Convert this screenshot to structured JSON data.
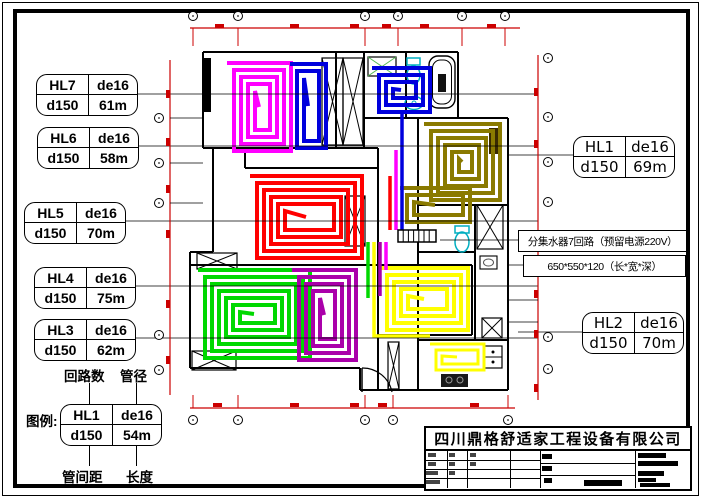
{
  "loop_labels": {
    "left": [
      {
        "id": "HL7",
        "pipe": "de16",
        "spacing": "d150",
        "length": "61m"
      },
      {
        "id": "HL6",
        "pipe": "de16",
        "spacing": "d150",
        "length": "58m"
      },
      {
        "id": "HL5",
        "pipe": "de16",
        "spacing": "d150",
        "length": "70m"
      },
      {
        "id": "HL4",
        "pipe": "de16",
        "spacing": "d150",
        "length": "75m"
      },
      {
        "id": "HL3",
        "pipe": "de16",
        "spacing": "d150",
        "length": "62m"
      }
    ],
    "right": [
      {
        "id": "HL1",
        "pipe": "de16",
        "spacing": "d150",
        "length": "69m"
      },
      {
        "id": "HL2",
        "pipe": "de16",
        "spacing": "d150",
        "length": "70m"
      }
    ],
    "legend": {
      "id": "HL1",
      "pipe": "de16",
      "spacing": "d150",
      "length": "54m"
    }
  },
  "callouts": {
    "legend_title": "图例:",
    "loops_count": "回路数",
    "pipe_dia": "管径",
    "pipe_spacing": "管间距",
    "length": "长度"
  },
  "manifold_note": {
    "line1": "分集水器7回路（预留电源220V）",
    "line2": "650*550*120（长*宽*深）"
  },
  "title_block": {
    "company": "四川鼎格舒适家工程设备有限公司"
  },
  "colors": {
    "wall": "#000000",
    "dimension_red": "#cc0000",
    "fixture_cyan": "#00aec0",
    "hatch_green": "#55bb55"
  },
  "coils": [
    {
      "loop": "HL7",
      "color": "#ff00ff",
      "x": 227,
      "y": 63,
      "w": 64,
      "h": 88,
      "gap": 7
    },
    {
      "loop": "HL6",
      "color": "#0000dd",
      "x": 290,
      "y": 64,
      "w": 36,
      "h": 84,
      "gap": 7
    },
    {
      "loop": "HL6",
      "color": "#0000dd",
      "x": 372,
      "y": 68,
      "w": 58,
      "h": 44,
      "gap": 7
    },
    {
      "loop": "HL1",
      "color": "#8a7a00",
      "x": 424,
      "y": 124,
      "w": 76,
      "h": 76,
      "gap": 7
    },
    {
      "loop": "HL1",
      "color": "#8a7a00",
      "x": 400,
      "y": 188,
      "w": 70,
      "h": 34,
      "gap": 7
    },
    {
      "loop": "HL5",
      "color": "#ff0000",
      "x": 250,
      "y": 176,
      "w": 112,
      "h": 82,
      "gap": 7
    },
    {
      "loop": "HL4",
      "color": "#00d800",
      "x": 198,
      "y": 270,
      "w": 112,
      "h": 88,
      "gap": 7
    },
    {
      "loop": "HL3",
      "color": "#aa00aa",
      "x": 292,
      "y": 270,
      "w": 64,
      "h": 90,
      "gap": 7
    },
    {
      "loop": "HL2",
      "color": "#ffff00",
      "x": 380,
      "y": 268,
      "w": 88,
      "h": 62,
      "gap": 7
    },
    {
      "loop": "HL2",
      "color": "#ffff00",
      "x": 430,
      "y": 344,
      "w": 54,
      "h": 26,
      "gap": 6
    }
  ],
  "risers": [
    {
      "color": "#0000dd",
      "path": "M402 112 L402 230"
    },
    {
      "color": "#ff00ff",
      "path": "M396 150 L396 230"
    },
    {
      "color": "#ff0000",
      "path": "M390 176 L390 230"
    },
    {
      "color": "#00d800",
      "path": "M368 242 L368 298"
    },
    {
      "color": "#ffff00",
      "path": "M374 242 L374 336 L430 336"
    },
    {
      "color": "#aa00aa",
      "path": "M380 242 L380 296"
    },
    {
      "color": "#ff00ff",
      "path": "M386 242 L386 270"
    }
  ]
}
